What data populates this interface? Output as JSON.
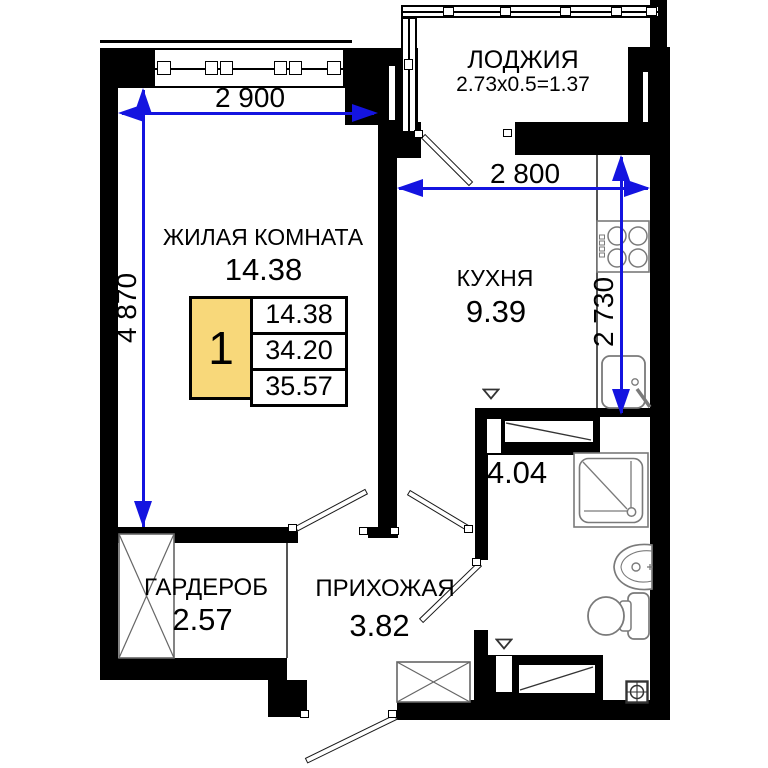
{
  "rooms": {
    "living": {
      "label": "ЖИЛАЯ КОМНАТА",
      "area": "14.38"
    },
    "kitchen": {
      "label": "КУХНЯ",
      "area": "9.39"
    },
    "loggia": {
      "label": "ЛОДЖИЯ",
      "calc": "2.73x0.5=1.37"
    },
    "bathroom": {
      "area": "4.04"
    },
    "wardrobe": {
      "label": "ГАРДЕРОБ",
      "area": "2.57"
    },
    "hallway": {
      "label": "ПРИХОЖАЯ",
      "area": "3.82"
    }
  },
  "dimensions": {
    "living_width": "2 900",
    "living_height": "4 870",
    "kitchen_width": "2 800",
    "kitchen_height": "2 730"
  },
  "legend": {
    "room_count": "1",
    "rows": [
      "14.38",
      "34.20",
      "35.57"
    ]
  },
  "colors": {
    "wall": "#000000",
    "dimension_blue": "#1414e0",
    "legend_yellow": "#f8d87a"
  }
}
